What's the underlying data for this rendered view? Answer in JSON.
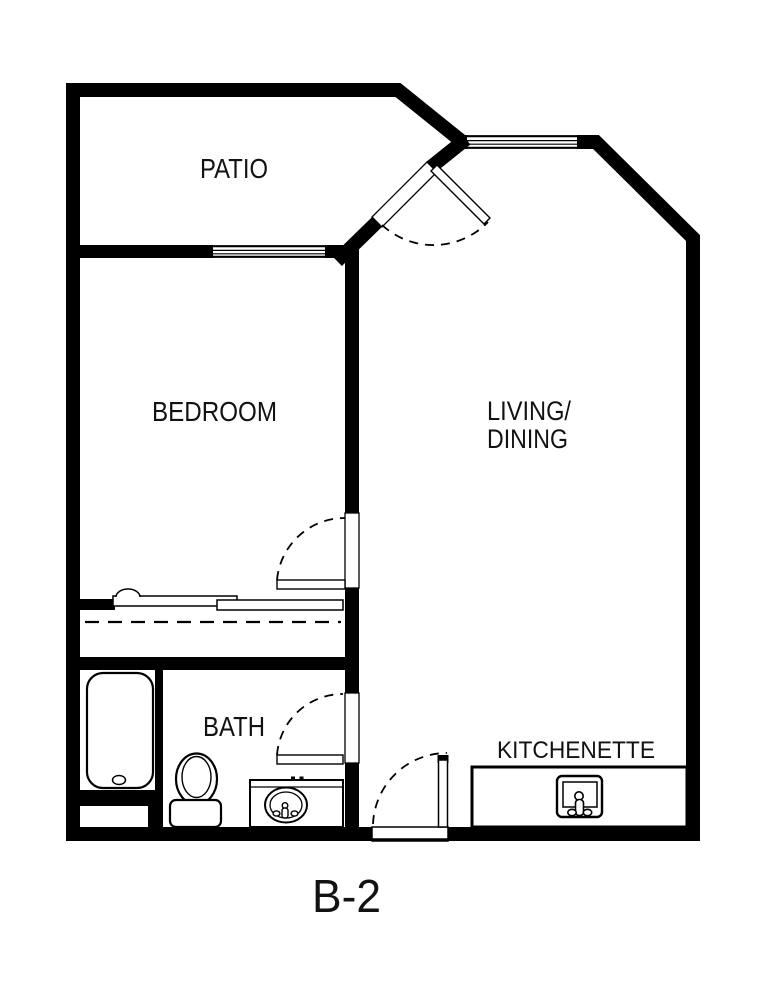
{
  "plan": {
    "name": "B-2",
    "rooms": {
      "patio": "PATIO",
      "bedroom": "BEDROOM",
      "living_dining_line1": "LIVING/",
      "living_dining_line2": "DINING",
      "bath": "BATH",
      "kitchenette": "KITCHENETTE"
    },
    "fixtures": {
      "bathtub": "bathtub",
      "toilet": "toilet",
      "vanity_sink": "vanity-sink",
      "kitchen_sink": "kitchen-sink",
      "closet_sliding_doors": "closet-sliding-doors"
    },
    "colors": {
      "wall": "#000000",
      "background": "#ffffff",
      "text": "#121212"
    }
  }
}
